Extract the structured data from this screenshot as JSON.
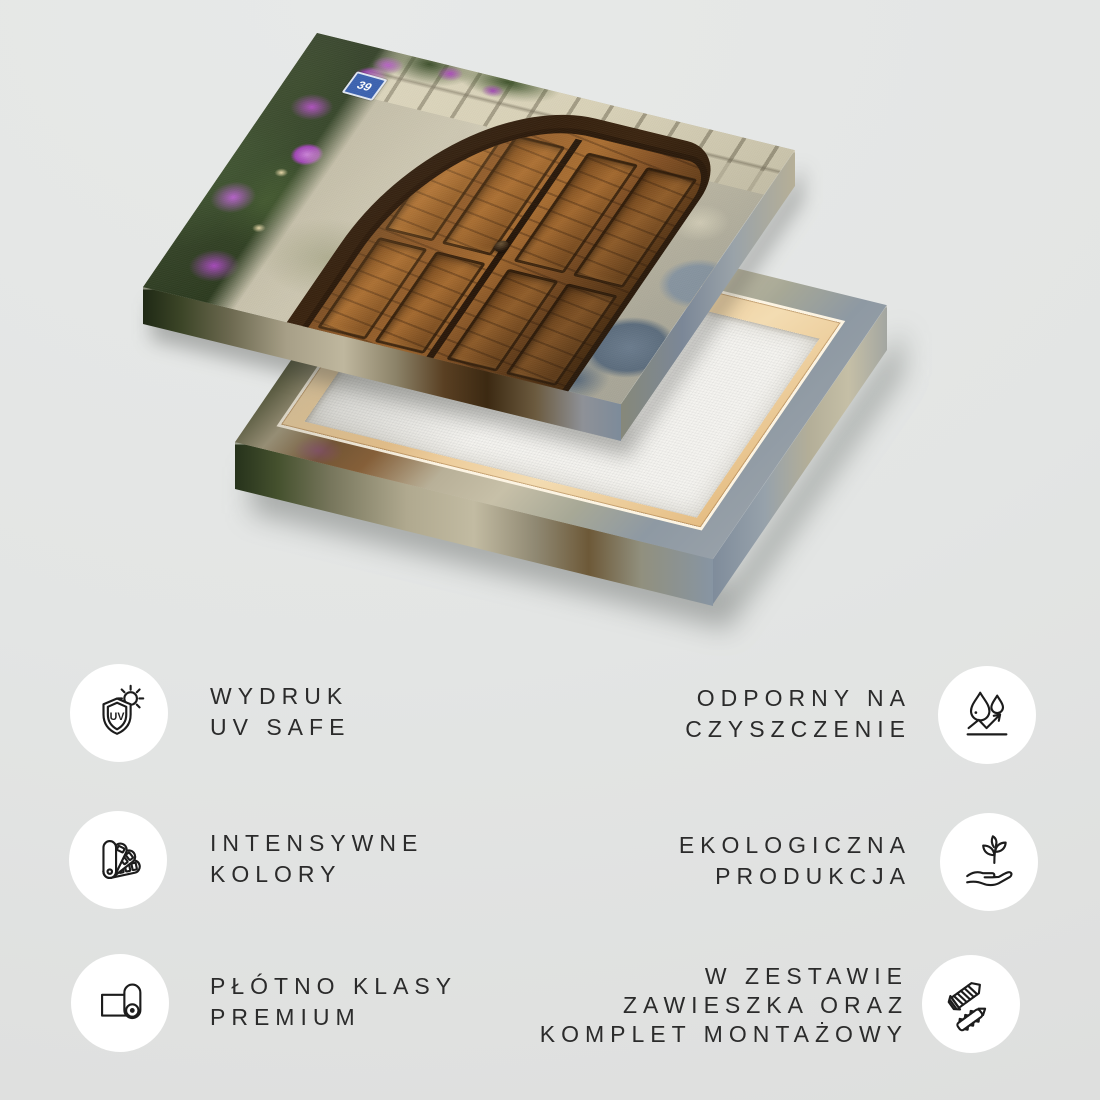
{
  "artwork": {
    "description": "canvas print of old arched wooden door with stone wall and purple bougainvillea, shown above its wooden stretcher frame back",
    "sign_text": "39",
    "colors": {
      "background": "#e2e4e3",
      "canvas_back": "#f4f3ef",
      "stretcher_wood": "#eac48e",
      "door_wood": "#8a5526",
      "flowers": "#a844b8",
      "stone": "#c9c3ad"
    }
  },
  "features": [
    {
      "id": "uv-safe",
      "icon": "uv-shield-sun-icon",
      "icon_text": "UV",
      "lines": [
        "WYDRUK",
        "UV SAFE"
      ]
    },
    {
      "id": "cleaning-resistant",
      "icon": "water-drops-bounce-icon",
      "lines": [
        "ODPORNY NA",
        "CZYSZCZENIE"
      ]
    },
    {
      "id": "intense-colors",
      "icon": "color-swatches-icon",
      "lines": [
        "INTENSYWNE",
        "KOLORY"
      ]
    },
    {
      "id": "eco-production",
      "icon": "hand-plant-icon",
      "lines": [
        "EKOLOGICZNA",
        "PRODUKCJA"
      ]
    },
    {
      "id": "premium-canvas",
      "icon": "canvas-roll-icon",
      "lines": [
        "PŁÓTNO KLASY",
        "PREMIUM"
      ]
    },
    {
      "id": "mounting-kit",
      "icon": "screw-anchor-icon",
      "lines": [
        "W ZESTAWIE",
        "ZAWIESZKA ORAZ",
        "KOMPLET MONTAŻOWY"
      ]
    }
  ],
  "text_color": "#2b2b2b",
  "icon_stroke": "#1c1c1c"
}
